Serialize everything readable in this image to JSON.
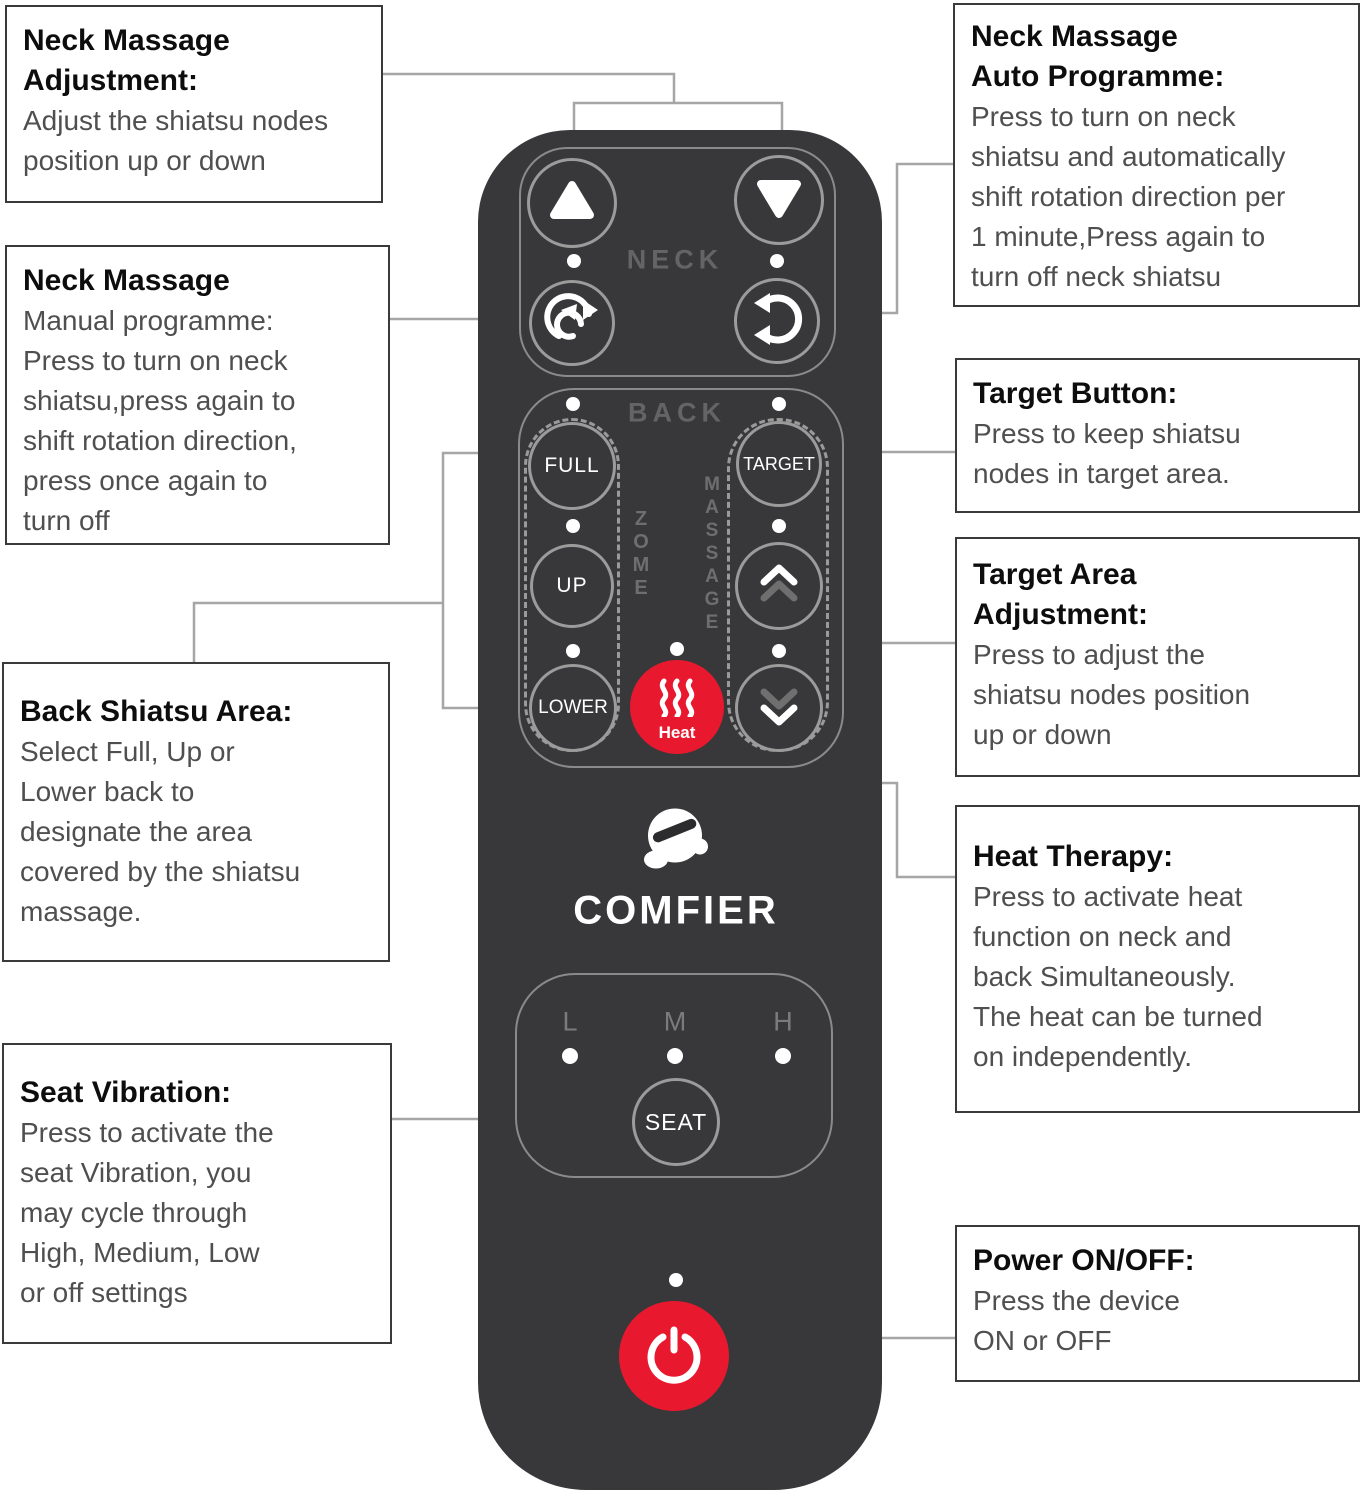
{
  "figure": "massage remote control annotated diagram",
  "callouts": {
    "neck_adjustment": {
      "title": "Neck Massage\nAdjustment:",
      "body": "Adjust the shiatsu nodes\nposition up or down"
    },
    "neck_manual": {
      "title": "Neck Massage",
      "body": "Manual programme:\nPress to turn on neck\nshiatsu,press again to\nshift rotation direction,\npress once again to\nturn off"
    },
    "back_area": {
      "title": "Back Shiatsu Area:",
      "body": "Select Full, Up or\nLower back to\ndesignate the area\ncovered by the shiatsu\nmassage."
    },
    "seat_vibration": {
      "title": "Seat Vibration:",
      "body": "Press to activate the\nseat Vibration, you\nmay cycle through\nHigh, Medium, Low\nor off settings"
    },
    "neck_auto": {
      "title": "Neck Massage\nAuto Programme:",
      "body": "Press to turn on neck\nshiatsu and automatically\nshift rotation direction per\n1 minute,Press again to\nturn off neck shiatsu"
    },
    "target_button": {
      "title": "Target Button:",
      "body": "Press to keep shiatsu\nnodes in target area."
    },
    "target_area": {
      "title": "Target Area\nAdjustment:",
      "body": "Press to adjust the\nshiatsu nodes position\nup or down"
    },
    "heat_therapy": {
      "title": "Heat Therapy:",
      "body": "Press to activate heat\nfunction on neck and\nback Simultaneously.\nThe heat can be turned\non independently."
    },
    "power": {
      "title": "Power ON/OFF:",
      "body": "Press the device\nON or OFF"
    }
  },
  "remote": {
    "brand": "COMFIER",
    "neck_section_label": "NECK",
    "back_section_label": "BACK",
    "zone_vertical": "Z\nO\nM\nE",
    "massage_vertical": "M\nA\nS\nS\nA\nG\nE",
    "buttons": {
      "full": "FULL",
      "up": "UP",
      "lower": "LOWER",
      "target": "TARGET",
      "heat": "Heat",
      "seat": "SEAT"
    },
    "seat_levels": {
      "low": "L",
      "medium": "M",
      "high": "H"
    }
  },
  "icons": [
    "neck-up-icon",
    "neck-down-icon",
    "rotate-cw-icon",
    "rotate-ccw-icon",
    "chevron-up-icon",
    "chevron-down-icon",
    "heat-waves-icon",
    "power-icon",
    "mascot-icon"
  ],
  "colors": {
    "remote_body": "#38383a",
    "accent_red": "#e8192e",
    "outline_gray": "#8a8a8a",
    "leader_gray": "#a6a6a6",
    "label_gray": "#646464",
    "white": "#ffffff"
  }
}
